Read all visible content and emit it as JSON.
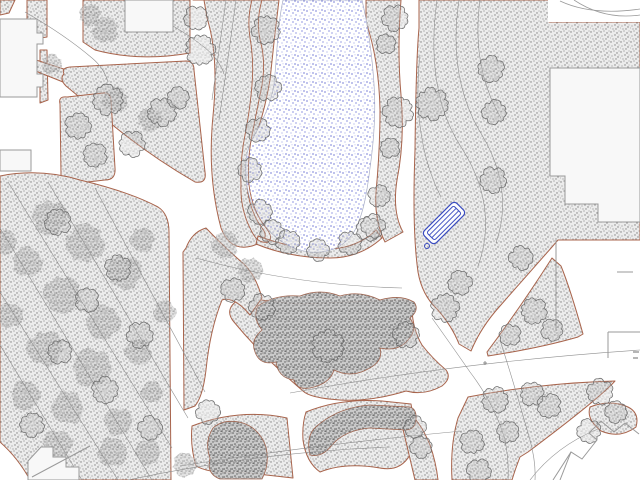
{
  "plan": {
    "canvas": {
      "w": 640,
      "h": 480,
      "bg": "#ffffff"
    },
    "palette": {
      "bed_outline": "#a8644c",
      "ground_dot": "#7e7e7e",
      "shrub_dot": "#4a4a4a",
      "water_dot": "#3b45c5",
      "water_edge": "#a9aec6",
      "contour": "#8f8f8f",
      "tree_stroke": "#6e6e6e",
      "building_fill": "#f8f8f8",
      "building_stroke": "#9a9a9a",
      "bench_blue": "#3a4cc0"
    },
    "water": {
      "id": "pond",
      "d": "M283,0 C277,28 277,58 274,84 C271,104 263,120 253,138 C246,151 245,163 246,176 C247,194 252,208 262,222 C274,239 291,250 310,252 C332,254 349,244 357,226 C364,210 367,192 370,168 C374,140 376,112 374,84 C372,54 368,26 362,0 Z"
    },
    "beds": [
      {
        "id": "wedge-tl",
        "d": "M0,0 L15,0 L9,13 L0,15 Z"
      },
      {
        "id": "band-tl-a",
        "d": "M27,0 L47,0 L47,37 L27,40 Z"
      },
      {
        "id": "band-tl-b",
        "d": "M40,50 L47,50 L48,100 L40,103 Z"
      },
      {
        "id": "band-tl-c",
        "d": "M30,58 L76,73 L73,86 L28,68 Z"
      },
      {
        "id": "top-block",
        "fr": "evenodd",
        "d": "M83,0 L190,0 L190,53 Q140,62 95,50 L83,42 Z M125,0 L173,0 L173,32 L125,32 Z"
      },
      {
        "id": "pond-west",
        "d": "M193,0 L279,0 Q274,40 270,80 Q264,115 254,140 Q246,162 247,185 Q249,210 262,228 Q272,240 252,246 Q230,252 221,228 Q207,176 213,116 Q219,56 207,18 L204,0 Z"
      },
      {
        "id": "triangle-1",
        "d": "M64,74 Q61,68 70,67 L186,61 Q194,61 194,70 L205,172 Q207,184 195,182 Q140,150 95,110 L66,86 Q59,79 64,74 Z"
      },
      {
        "id": "triangle-2",
        "d": "M60,104 Q58,96 67,97 L103,93 Q110,92 111,100 L115,168 Q116,180 105,180 L70,184 Q61,185 61,175 Z"
      },
      {
        "id": "west-forest",
        "d": "M0,176 Q40,168 80,180 Q130,192 158,207 Q169,214 169,232 L171,480 L30,480 Q18,458 0,442 Z"
      },
      {
        "id": "east-main",
        "d": "M419,0 L552,0 L549,22 L640,22 L640,240 L558,240 L552,247 L500,306 Q481,327 471,351 L459,344 Q452,326 437,309 Q422,295 418,272 Q412,230 415,150 Q416,60 419,28 Z"
      },
      {
        "id": "pond-east-strip",
        "d": "M366,0 L401,0 Q397,50 401,95 Q405,140 397,180 Q392,212 403,232 L385,242 Q374,220 376,192 Q380,150 380,110 Q379,60 366,22 Z"
      },
      {
        "id": "pond-bottom-strip",
        "d": "M258,236 Q300,252 340,248 Q362,244 376,230 L382,238 Q360,258 330,258 Q290,258 256,244 Z"
      },
      {
        "id": "center-north",
        "d": "M243,297 Q270,302 300,304 L398,300 Q410,299 412,310 Q413,330 422,345 Q432,358 446,370 Q452,378 442,386 Q424,396 406,391 Q370,402 340,400 Q310,398 303,391 Q262,356 234,322 Q222,308 243,297 Z"
      },
      {
        "id": "mid-strip",
        "d": "M186,248 Q192,232 206,228 Q225,248 244,264 Q256,276 262,298 L250,315 Q234,296 222,300 Q210,330 206,370 Q203,396 195,406 L184,410 L183,252 Z"
      },
      {
        "id": "center-south",
        "d": "M192,426 Q240,408 287,418 L293,478 L240,472 Q210,474 196,466 Q190,446 192,426 Z"
      },
      {
        "id": "s-bed",
        "d": "M306,412 Q340,398 382,401 L411,404 Q416,430 410,455 Q400,472 380,468 Q345,462 320,472 Q306,462 303,440 Q302,424 306,412 Z"
      },
      {
        "id": "strip-w-of-path",
        "d": "M404,408 Q420,420 430,445 Q436,462 438,480 L415,480 Q408,450 402,425 Z"
      },
      {
        "id": "southeast-main",
        "d": "M468,397 Q540,383 615,381 Q600,398 528,452 L520,457 Q515,470 512,480 L452,480 Q450,445 458,418 Z"
      },
      {
        "id": "southeast-patch",
        "d": "M590,407 Q610,399 628,407 Q640,413 636,427 Q620,439 601,431 Q586,419 590,407 Z"
      },
      {
        "id": "east-wedge",
        "d": "M488,356 Q540,348 578,337 L583,334 Q570,288 561,266 L552,258 Q520,308 487,352 Z"
      }
    ],
    "hedge": {
      "d": "M262,0 Q256,20 260,40 Q266,60 262,85 Q257,110 252,135 Q247,160 249,185 Q252,210 266,228 Q274,238 268,242 Q258,244 252,232 Q240,210 241,185 Q240,160 245,135 Q250,110 252,85 Q254,60 250,38 Q247,18 252,0 Z"
    },
    "shrub_masses": [
      {
        "id": "center-mass",
        "d": "M258,306 Q252,318 262,330 Q250,340 255,352 Q260,366 276,362 Q278,378 294,380 Q296,390 310,388 Q330,384 334,370 Q350,378 366,370 Q384,362 380,348 Q398,352 408,340 Q418,330 410,318 Q420,310 414,302 Q400,294 380,300 Q360,290 340,296 Q320,288 300,296 Q275,294 258,306 Z"
      },
      {
        "id": "round-shrub",
        "d": "M213,428 Q204,442 210,458 Q206,474 220,479 L262,479 Q270,464 266,447 Q260,429 243,423 Q224,418 213,428 Z"
      },
      {
        "id": "s-shrub",
        "d": "M310,455 Q305,435 318,425 Q340,407 370,405 L410,407 Q417,409 416,420 Q415,430 405,430 L370,428 Q345,430 332,445 Q322,458 310,455 Z"
      }
    ],
    "canopies": [
      {
        "x": 50,
        "y": 218,
        "r": 18
      },
      {
        "x": 85,
        "y": 243,
        "r": 20
      },
      {
        "x": 125,
        "y": 272,
        "r": 18
      },
      {
        "x": 28,
        "y": 262,
        "r": 16
      },
      {
        "x": 62,
        "y": 295,
        "r": 20
      },
      {
        "x": 103,
        "y": 322,
        "r": 19
      },
      {
        "x": 45,
        "y": 348,
        "r": 20
      },
      {
        "x": 92,
        "y": 368,
        "r": 22
      },
      {
        "x": 138,
        "y": 352,
        "r": 16
      },
      {
        "x": 25,
        "y": 395,
        "r": 18
      },
      {
        "x": 68,
        "y": 408,
        "r": 20
      },
      {
        "x": 118,
        "y": 422,
        "r": 18
      },
      {
        "x": 152,
        "y": 392,
        "r": 14
      },
      {
        "x": 58,
        "y": 445,
        "r": 18
      },
      {
        "x": 112,
        "y": 452,
        "r": 18
      },
      {
        "x": 148,
        "y": 452,
        "r": 15
      },
      {
        "x": 165,
        "y": 312,
        "r": 13
      },
      {
        "x": 142,
        "y": 240,
        "r": 14
      },
      {
        "x": 10,
        "y": 315,
        "r": 14
      },
      {
        "x": 5,
        "y": 242,
        "r": 13
      },
      {
        "x": 185,
        "y": 465,
        "r": 13
      },
      {
        "x": 225,
        "y": 245,
        "r": 14
      },
      {
        "x": 250,
        "y": 270,
        "r": 13
      },
      {
        "x": 115,
        "y": 100,
        "r": 13
      },
      {
        "x": 150,
        "y": 120,
        "r": 12
      },
      {
        "x": 105,
        "y": 30,
        "r": 13
      },
      {
        "x": 90,
        "y": 15,
        "r": 11
      },
      {
        "x": 52,
        "y": 64,
        "r": 10
      }
    ],
    "trees": [
      {
        "x": 196,
        "y": 18,
        "r": 12
      },
      {
        "x": 200,
        "y": 50,
        "r": 15
      },
      {
        "x": 266,
        "y": 30,
        "r": 14
      },
      {
        "x": 268,
        "y": 88,
        "r": 13
      },
      {
        "x": 258,
        "y": 130,
        "r": 12
      },
      {
        "x": 250,
        "y": 170,
        "r": 12
      },
      {
        "x": 260,
        "y": 212,
        "r": 12
      },
      {
        "x": 272,
        "y": 232,
        "r": 12
      },
      {
        "x": 288,
        "y": 242,
        "r": 12
      },
      {
        "x": 318,
        "y": 250,
        "r": 11
      },
      {
        "x": 350,
        "y": 243,
        "r": 12
      },
      {
        "x": 368,
        "y": 229,
        "r": 12
      },
      {
        "x": 395,
        "y": 18,
        "r": 13
      },
      {
        "x": 386,
        "y": 44,
        "r": 10
      },
      {
        "x": 398,
        "y": 112,
        "r": 15
      },
      {
        "x": 390,
        "y": 148,
        "r": 10
      },
      {
        "x": 379,
        "y": 196,
        "r": 11
      },
      {
        "x": 373,
        "y": 226,
        "r": 12
      },
      {
        "x": 108,
        "y": 100,
        "r": 15
      },
      {
        "x": 132,
        "y": 144,
        "r": 13
      },
      {
        "x": 162,
        "y": 112,
        "r": 14
      },
      {
        "x": 178,
        "y": 98,
        "r": 11
      },
      {
        "x": 78,
        "y": 126,
        "r": 13
      },
      {
        "x": 95,
        "y": 155,
        "r": 12
      },
      {
        "x": 432,
        "y": 104,
        "r": 16
      },
      {
        "x": 491,
        "y": 69,
        "r": 13
      },
      {
        "x": 494,
        "y": 112,
        "r": 12
      },
      {
        "x": 493,
        "y": 180,
        "r": 13
      },
      {
        "x": 521,
        "y": 258,
        "r": 12
      },
      {
        "x": 460,
        "y": 283,
        "r": 12
      },
      {
        "x": 445,
        "y": 308,
        "r": 14
      },
      {
        "x": 534,
        "y": 311,
        "r": 13
      },
      {
        "x": 552,
        "y": 330,
        "r": 11
      },
      {
        "x": 510,
        "y": 335,
        "r": 11
      },
      {
        "x": 233,
        "y": 290,
        "r": 12
      },
      {
        "x": 262,
        "y": 307,
        "r": 13
      },
      {
        "x": 406,
        "y": 335,
        "r": 13
      },
      {
        "x": 328,
        "y": 346,
        "r": 16
      },
      {
        "x": 208,
        "y": 412,
        "r": 12
      },
      {
        "x": 415,
        "y": 427,
        "r": 11
      },
      {
        "x": 421,
        "y": 447,
        "r": 11
      },
      {
        "x": 495,
        "y": 400,
        "r": 13
      },
      {
        "x": 532,
        "y": 394,
        "r": 12
      },
      {
        "x": 549,
        "y": 406,
        "r": 12
      },
      {
        "x": 472,
        "y": 442,
        "r": 12
      },
      {
        "x": 479,
        "y": 471,
        "r": 12
      },
      {
        "x": 508,
        "y": 432,
        "r": 11
      },
      {
        "x": 600,
        "y": 392,
        "r": 13
      },
      {
        "x": 616,
        "y": 412,
        "r": 11
      },
      {
        "x": 589,
        "y": 431,
        "r": 12
      },
      {
        "x": 58,
        "y": 222,
        "r": 13
      },
      {
        "x": 118,
        "y": 268,
        "r": 13
      },
      {
        "x": 87,
        "y": 300,
        "r": 12
      },
      {
        "x": 140,
        "y": 335,
        "r": 13
      },
      {
        "x": 60,
        "y": 352,
        "r": 12
      },
      {
        "x": 105,
        "y": 390,
        "r": 13
      },
      {
        "x": 32,
        "y": 425,
        "r": 12
      },
      {
        "x": 150,
        "y": 428,
        "r": 12
      }
    ],
    "contours": [
      {
        "d": "M8,182 L172,448"
      },
      {
        "d": "M0,228 L152,480"
      },
      {
        "d": "M48,182 L188,418"
      },
      {
        "d": "M0,292 L118,480"
      },
      {
        "d": "M95,188 L205,392"
      },
      {
        "d": "M0,345 L82,480"
      },
      {
        "d": "M236,0 Q228,60 219,120"
      },
      {
        "d": "M226,0 Q219,50 212,100"
      },
      {
        "d": "M25,12 Q65,35 92,58 Q104,68 108,82"
      },
      {
        "d": "M132,5 Q178,26 204,47 Q219,59 224,74"
      },
      {
        "d": "M437,0 C429,58 436,108 461,147 C487,187 492,228 478,266"
      },
      {
        "d": "M459,0 C451,54 459,98 482,135 C504,172 508,208 496,243"
      },
      {
        "d": "M480,0 C474,44 481,84 501,118"
      },
      {
        "d": "M420,55 C414,108 421,158 441,197"
      },
      {
        "d": "M432,318 Q452,346 470,372 Q495,405 505,440 Q509,460 508,480"
      },
      {
        "d": "M500,340 Q516,390 530,440 Q536,462 535,480"
      },
      {
        "d": "M196,258 Q292,285 402,288"
      },
      {
        "d": "M290,393 Q460,362 640,350"
      },
      {
        "d": "M180,466 Q320,444 462,431"
      },
      {
        "d": "M128,480 Q260,452 390,447"
      },
      {
        "d": "M530,480 Q556,446 598,429"
      }
    ],
    "buildings": {
      "solids": [
        {
          "id": "top-mid",
          "d": "M125,0 L173,0 L173,32 L125,32 Z"
        },
        {
          "id": "west-tower",
          "d": "M0,19 L37,19 L37,33 L43,33 L43,44 L37,44 L37,74 L43,74 L43,87 L37,87 L37,97 L0,97 Z"
        },
        {
          "id": "west-small",
          "d": "M0,150 L31,150 L31,171 L0,171 Z"
        },
        {
          "id": "east-large",
          "d": "M550,68 L640,68 L640,222 L598,222 L598,204 L565,204 L565,176 L550,176 Z"
        },
        {
          "id": "southwest-steps",
          "d": "M28,480 L28,461 L41,447 L53,447 L53,457 L66,457 L66,467 L79,467 L79,480 Z"
        }
      ],
      "lines": [
        {
          "d": "M556,240 L556,331"
        },
        {
          "d": "M608,332 L640,332"
        },
        {
          "d": "M608,332 L608,358"
        },
        {
          "d": "M617,272 L633,272"
        },
        {
          "d": "M32,477 L90,446"
        },
        {
          "d": "M553,480 L571,452 L582,459 L597,440 L589,433 L601,421 L614,432 L625,423 L639,434"
        },
        {
          "d": "M560,480 L571,452"
        }
      ],
      "corner_plate": {
        "rect": {
          "x": 548,
          "y": 0,
          "w": 92,
          "h": 22
        },
        "curves": [
          {
            "d": "M560,1 Q592,16 640,9"
          },
          {
            "d": "M574,0 Q604,20 640,15"
          }
        ]
      }
    },
    "bench": {
      "cx": 444,
      "cy": 223,
      "angle": -45,
      "len": 46,
      "wid": 17,
      "inner_len": 38,
      "inner_wid": 11,
      "slat_offsets": [
        -1.8,
        1.8
      ],
      "dot": {
        "x": 427,
        "y": 246,
        "r": 2.5
      }
    },
    "marks": {
      "junction_point": {
        "d": "M483,363 L487,363 M485,361 L485,365"
      },
      "edge_label_fragment": {
        "d": "M633,352 L639,352 M633,358 L638,358"
      }
    }
  }
}
